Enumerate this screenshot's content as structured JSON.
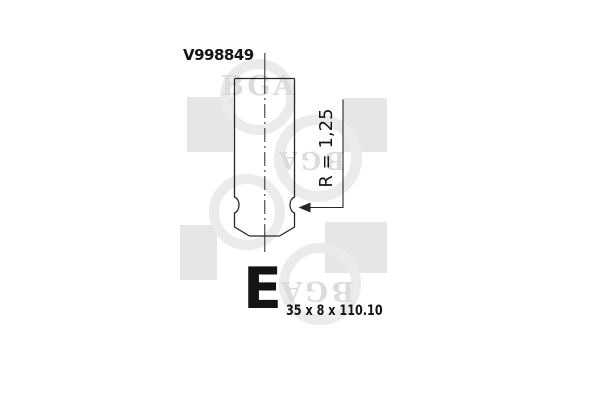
{
  "part": {
    "number": "V998849",
    "size_class": "E",
    "dimensions": "35 x 8 x 110.10",
    "radius_label": "R = 1,25"
  },
  "watermark": {
    "brand": "BGA",
    "instances": [
      "BGA",
      "BGA",
      "BGA"
    ]
  },
  "colors": {
    "background": "#ffffff",
    "line": "#262626",
    "text": "#141414",
    "watermark_square": "#e6e6e6",
    "watermark_ring": "#ebebeb",
    "watermark_letter": "#dcdcdc"
  }
}
